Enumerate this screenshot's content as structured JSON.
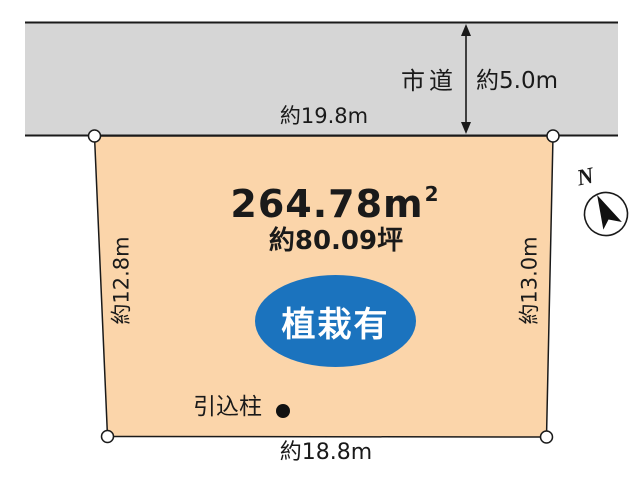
{
  "title": "land-plot-diagram",
  "road": {
    "name": "市道",
    "width_label": "約5.0m"
  },
  "dimensions": {
    "top": "約19.8m",
    "bottom": "約18.8m",
    "left": "約12.8m",
    "right": "約13.0m"
  },
  "parcel": {
    "area_value": "264.78",
    "area_unit": "m",
    "area_sup": "2",
    "area_tsubo": "約80.09坪",
    "planting_label": "植栽有",
    "pole_label": "引込柱"
  },
  "compass": {
    "north_label": "N"
  },
  "colors": {
    "road_fill": "#D6D6D6",
    "parcel_fill": "#FBD5AA",
    "planting_blue": "#1B73BE",
    "line": "#1A1A1A"
  }
}
